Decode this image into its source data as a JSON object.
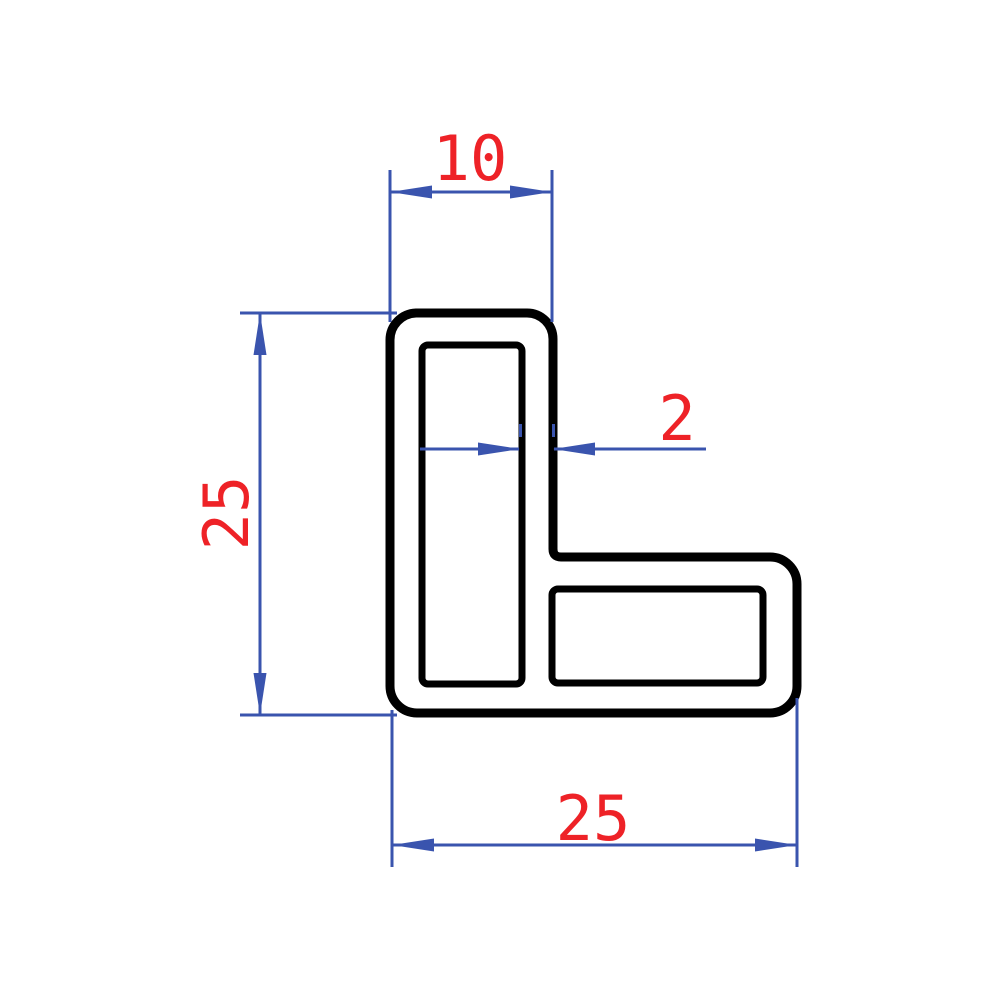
{
  "drawing": {
    "title": "L-profile cross-section technical drawing",
    "shape": "L-angle hollow profile with two chambers, rounded outer corners",
    "dimensions": {
      "top_flange_width": {
        "value": "10",
        "orientation": "horizontal",
        "position": "top"
      },
      "left_height": {
        "value": "25",
        "orientation": "vertical",
        "position": "left"
      },
      "wall_thickness": {
        "value": "2",
        "orientation": "horizontal",
        "position": "middle"
      },
      "bottom_width": {
        "value": "25",
        "orientation": "horizontal",
        "position": "bottom"
      }
    },
    "colors": {
      "outline": "#000000",
      "dimension_lines": "#3a54ae",
      "dimension_text": "#ee2227",
      "background": "#ffffff"
    }
  }
}
